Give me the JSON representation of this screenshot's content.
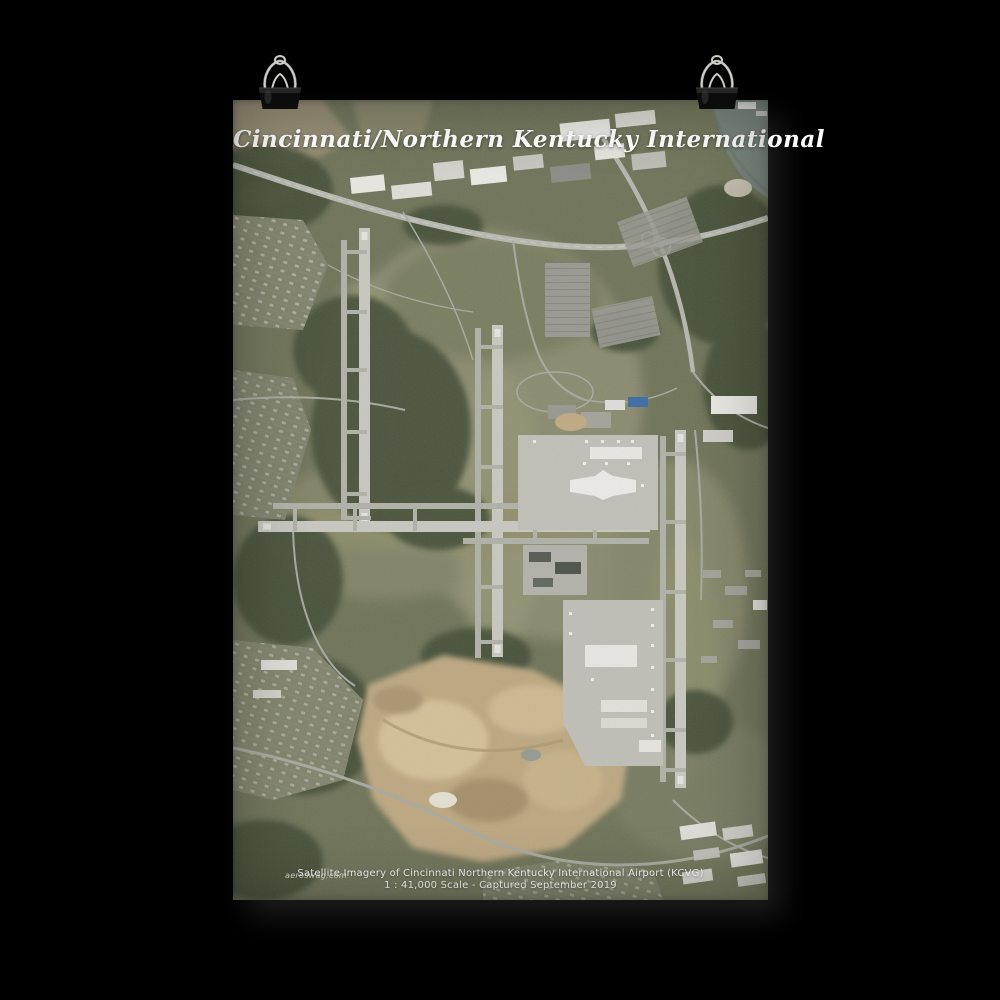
{
  "scene": {
    "background_color": "#000000",
    "description": "black binder clips holding a satellite-imagery poster on a black wall"
  },
  "poster": {
    "title": "Cincinnati/Northern Kentucky International",
    "caption_line1": "Satellite Imagery of Cincinnati Northern Kentucky International Airport (KCVG)",
    "caption_line2": "1 : 41,000 Scale - Captured September 2019",
    "watermark": "aeroswag.com",
    "title_color": "#ffffff",
    "caption_color": "#f2f2ee"
  },
  "map": {
    "type": "satellite-imagery",
    "subject": "Cincinnati/Northern Kentucky International Airport (KCVG)",
    "features": [
      "north-south runway 18L/36R",
      "north-south runway 18C/36C",
      "east-west runway 9/27",
      "north-south runway 18R/36L",
      "taxiways",
      "passenger terminal and concourses",
      "cargo apron with parked aircraft",
      "parking lots",
      "interstate highway interchange",
      "warehouse district",
      "residential neighborhoods",
      "forest",
      "sand quarry",
      "ohio-river"
    ],
    "colors": {
      "terrain_olive": "#71765a",
      "field_light": "#8e8f73",
      "forest_dark": "#454f37",
      "runway": "#d0d0ca",
      "taxiway": "#b6b7ae",
      "apron": "#c7c7c0",
      "building_white": "#f2f1ec",
      "quarry_tan": "#c4ad85",
      "river_teal": "#78867d",
      "highway": "#bfc0b8"
    }
  },
  "clips": {
    "count": 2,
    "body_color": "#0c0c0c",
    "wire_color": "#c6c6c0",
    "style": "black binder clip"
  }
}
